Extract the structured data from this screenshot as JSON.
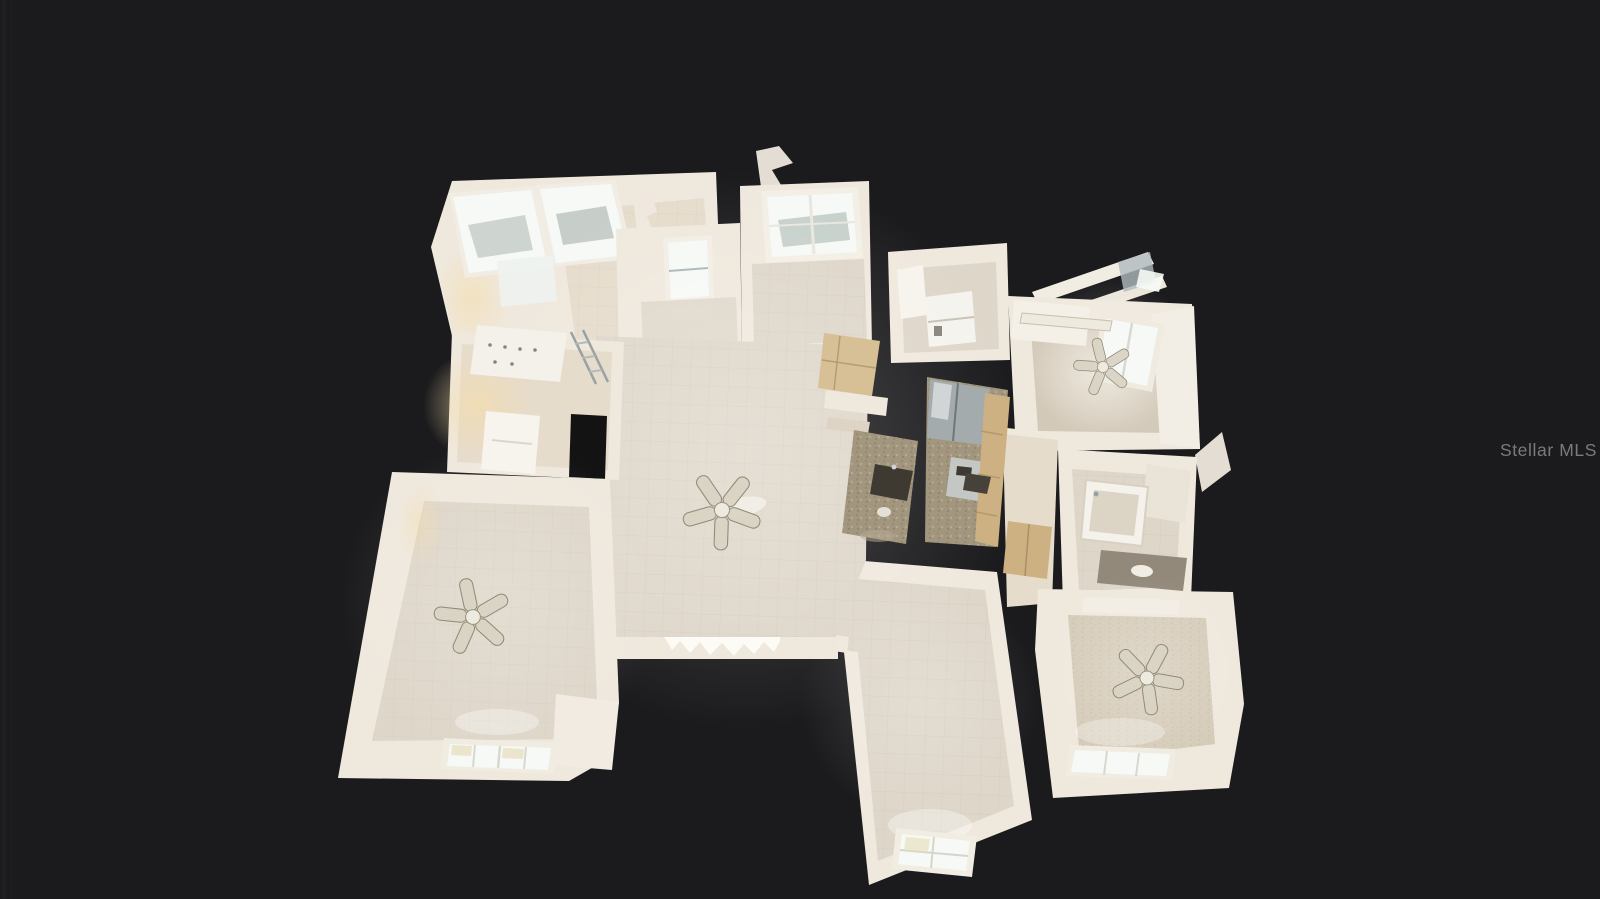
{
  "watermark": {
    "text": "Stellar MLS"
  },
  "palette": {
    "background": "#1b1b1d",
    "wall": "#efe8dd",
    "wall_shade": "#ded4c6",
    "floor_tile": "#ded6c9",
    "floor_warm": "#e6dccc",
    "glass": "#f6f9f5",
    "granite": "#a2967f",
    "cabinet": "#cdb183",
    "stainless": "#a4abac",
    "doorway_dark": "#131313",
    "watermark_color": "#8b8b8b"
  },
  "scene": {
    "view_type": "3D dollhouse top-down interior scan",
    "ceiling_fan_count": 4
  }
}
